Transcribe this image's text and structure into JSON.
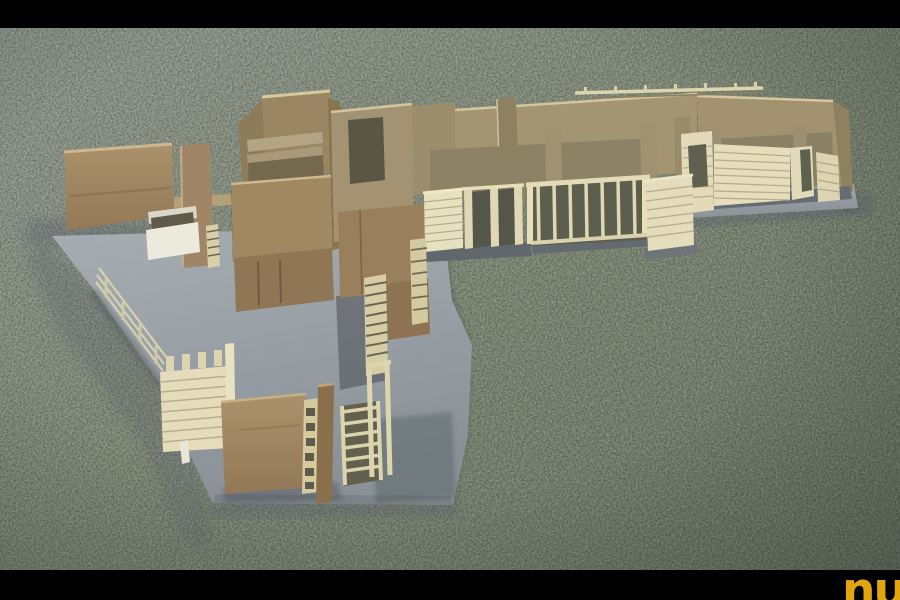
{
  "scene": {
    "type": "photograph",
    "subject": "Wooden architectural scale model standing on gray chipboard base plates, photographed on a speckled gray-green carpet, letterboxed with black bars",
    "letterbox": {
      "color": "#000000"
    },
    "carpet_color": "#87917e",
    "base_plate_color": "#9aa2a8",
    "wood_colors": {
      "brown": "#9d8260",
      "tan": "#a39472",
      "cream": "#e4dcb8",
      "dark_opening": "#5c5f4e"
    },
    "elements": [
      "left free-standing wall panel",
      "white planter box",
      "tall corner post",
      "open-top wooden room enclosure with interior partitions",
      "wall with doorway opening",
      "long rear wall with pergola beam",
      "vertical-baluster fences",
      "gate with three stiles and dark panels",
      "horizontal-slat walls",
      "right wing rooms with window openings on gray base",
      "courtyard with slat wall, solid brown wall, ladders and door frame"
    ],
    "logo": {
      "text": "nu",
      "color": "#e2a50e"
    }
  }
}
